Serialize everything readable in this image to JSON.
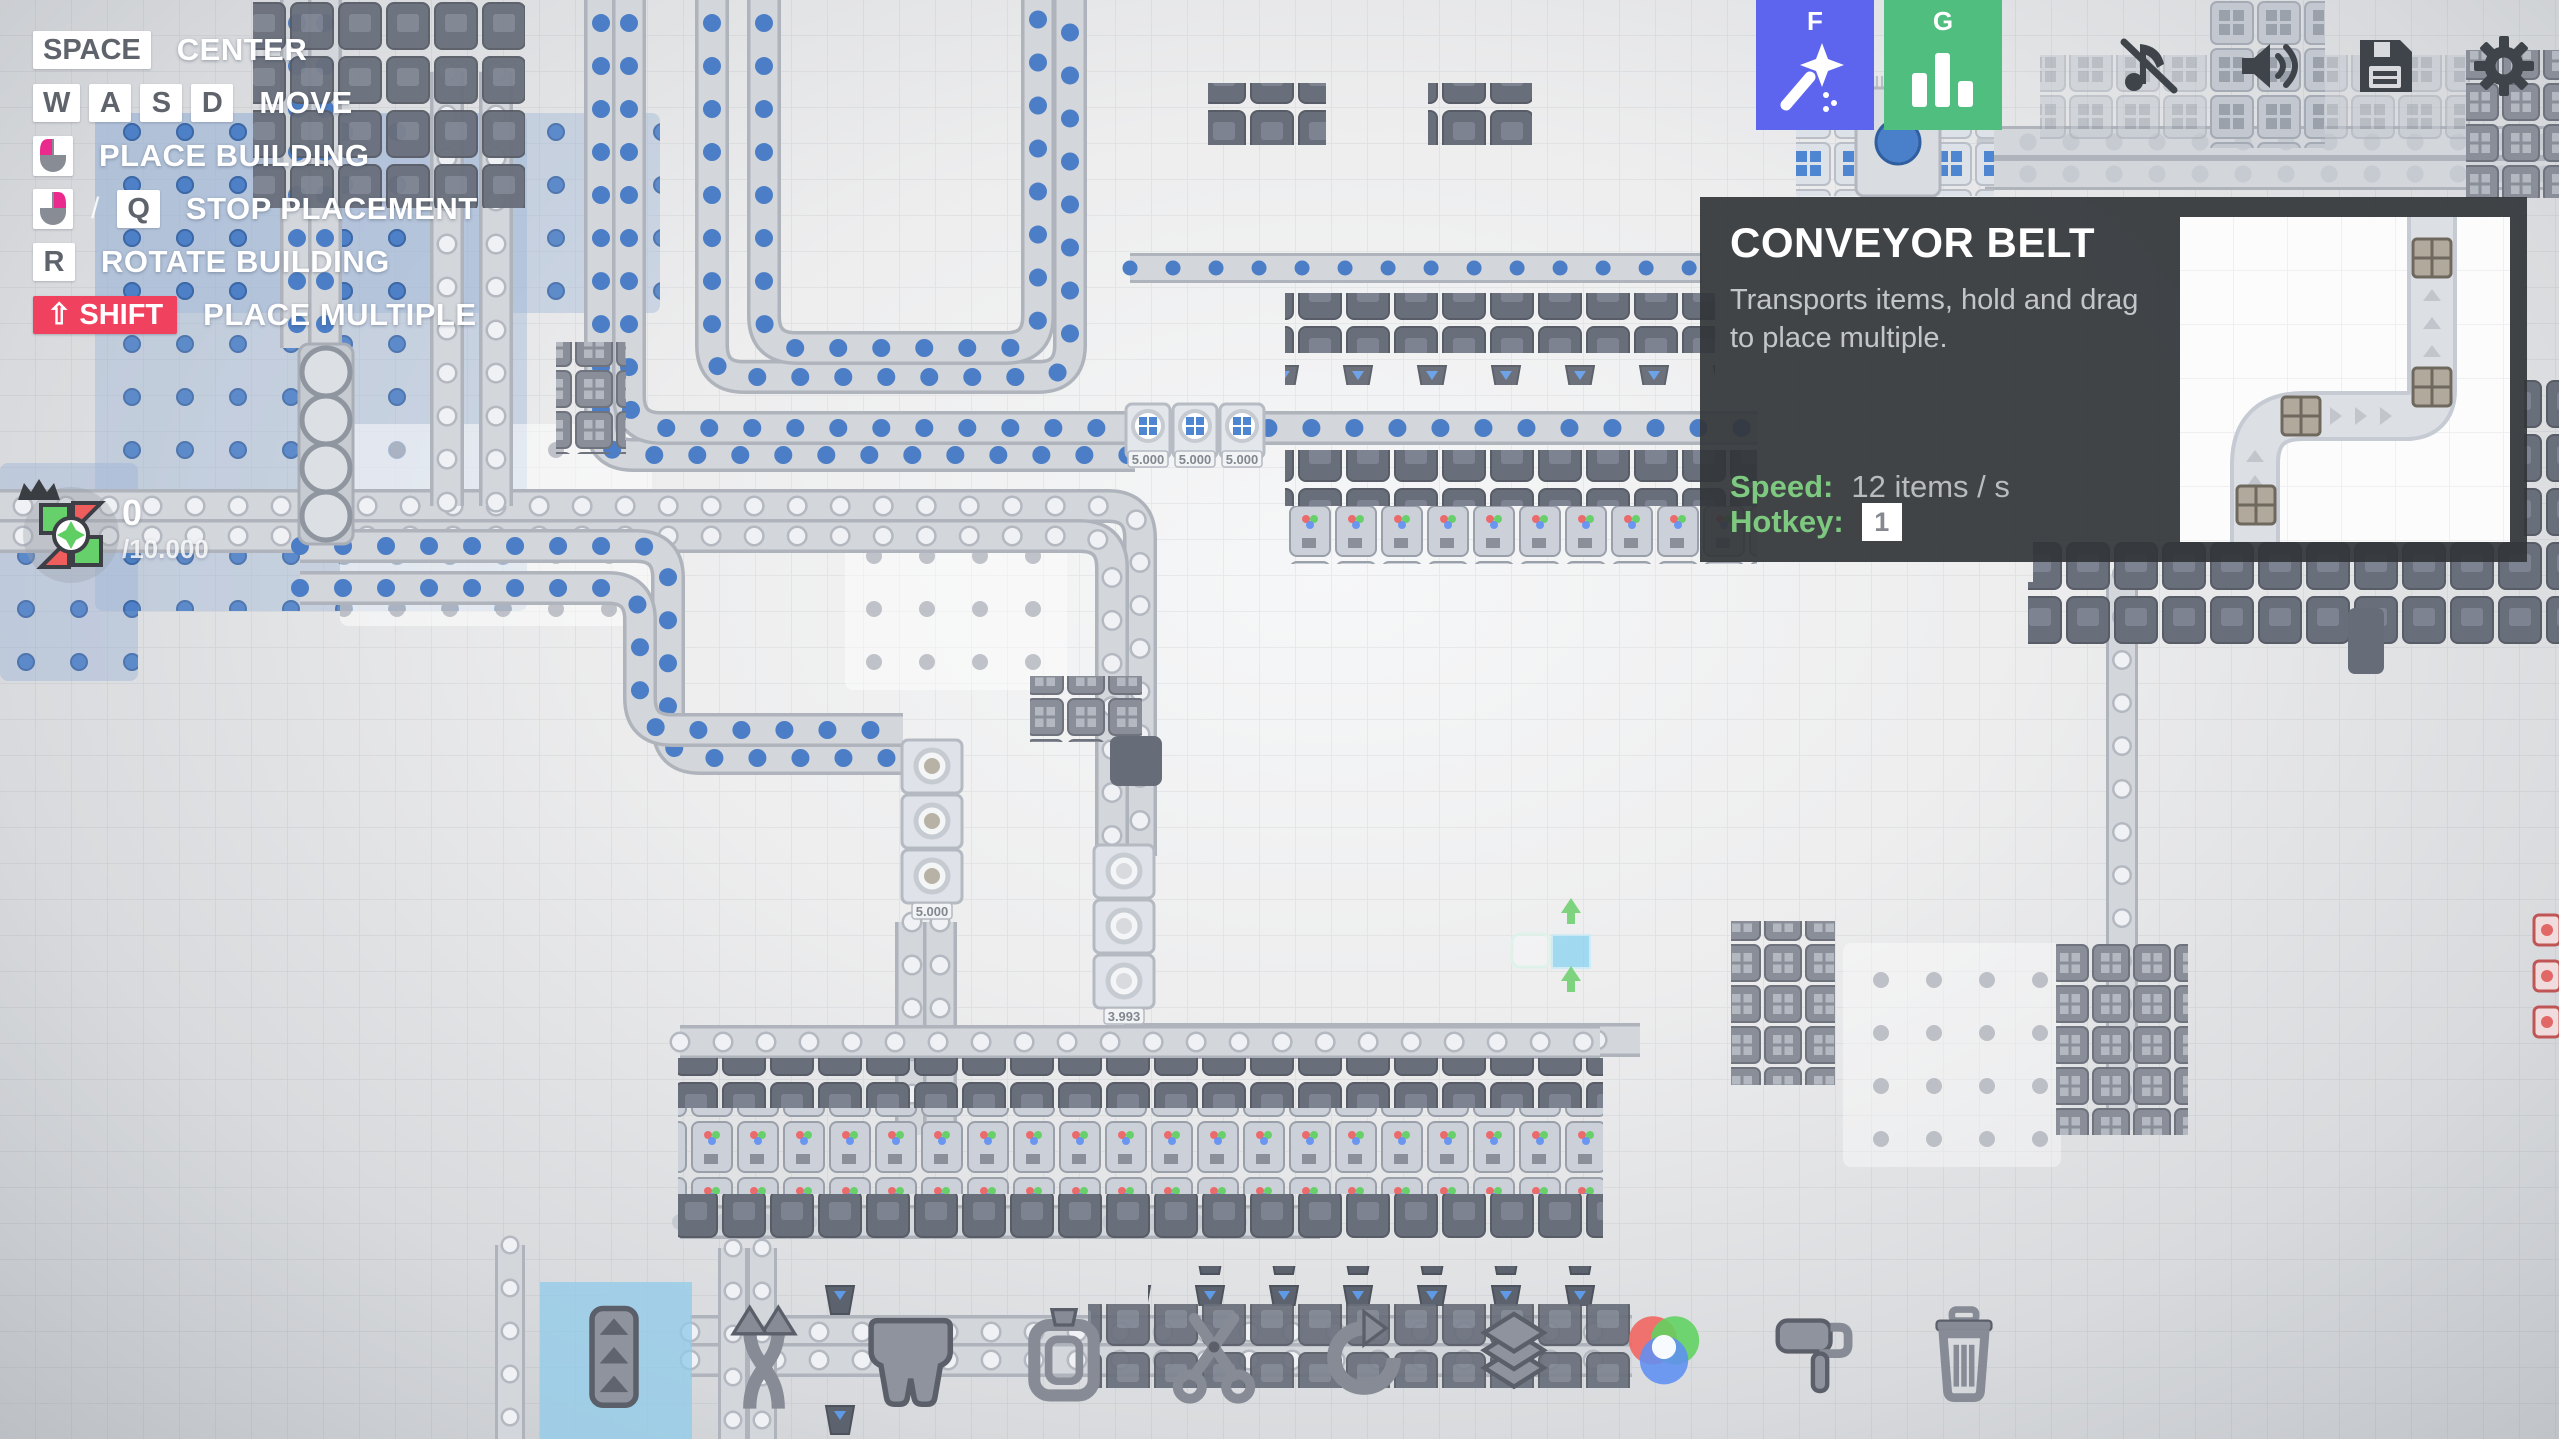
{
  "hints": {
    "rows": [
      {
        "keys": [
          "SPACE"
        ],
        "label": "CENTER"
      },
      {
        "keys": [
          "W",
          "A",
          "S",
          "D"
        ],
        "label": "MOVE"
      },
      {
        "mouse": "left-button",
        "label": "PLACE BUILDING"
      },
      {
        "mouse": "right-button",
        "separator": "/",
        "keys": [
          "Q"
        ],
        "label": "STOP PLACEMENT"
      },
      {
        "keys": [
          "R"
        ],
        "label": "ROTATE BUILDING"
      },
      {
        "keys": [
          "⇧ SHIFT"
        ],
        "label": "PLACE MULTIPLE",
        "accent": "#f0415f"
      }
    ]
  },
  "goal": {
    "current": "0",
    "total": "/10.000"
  },
  "top_right": {
    "wand_button": {
      "key": "F",
      "color": "#5d64ee",
      "icon": "magic-wand-icon"
    },
    "stats_button": {
      "key": "G",
      "color": "#4fbe7f",
      "icon": "bar-chart-icon"
    },
    "icons": [
      {
        "name": "music-muted-icon"
      },
      {
        "name": "volume-icon"
      },
      {
        "name": "save-icon"
      },
      {
        "name": "settings-gear-icon"
      }
    ]
  },
  "tooltip": {
    "title": "CONVEYOR BELT",
    "description": "Transports items, hold and drag to place multiple.",
    "speed_label": "Speed:",
    "speed_value": "12 items / s",
    "hotkey_label": "Hotkey:",
    "hotkey_value": "1",
    "accent_color": "#7dc97f"
  },
  "toolbar": {
    "selected": "belt",
    "selected_bg": "#92cce9",
    "items": [
      {
        "name": "belt",
        "icon": "belt-icon",
        "selected": true
      },
      {
        "name": "balancer",
        "icon": "balancer-icon",
        "selected": false
      },
      {
        "name": "tunnel",
        "icon": "tunnel-icon",
        "selected": false
      },
      {
        "name": "miner",
        "icon": "miner-icon",
        "selected": false
      },
      {
        "name": "cutter",
        "icon": "cutter-icon",
        "selected": false
      },
      {
        "name": "rotator",
        "icon": "rotator-icon",
        "selected": false
      },
      {
        "name": "stacker",
        "icon": "stacker-icon",
        "selected": false
      },
      {
        "name": "mixer",
        "icon": "mixer-icon",
        "selected": false
      },
      {
        "name": "painter",
        "icon": "painter-icon",
        "selected": false
      },
      {
        "name": "trash",
        "icon": "trash-icon",
        "selected": false
      }
    ]
  },
  "canvas": {
    "counters": [
      "5.000",
      "5.000",
      "5.000",
      "1.531",
      "5.000",
      "5.000",
      "5.000",
      "5.000",
      "3.993"
    ],
    "colors": {
      "item_blue": "#4b7ec6",
      "belt_track": "#d3d6db",
      "machine_dark": "#686e7a",
      "patch_blue": "#9db4d6",
      "ghost_cyan": "#79d0f2",
      "ghost_green": "#7ed37e",
      "red_item": "#e26868"
    }
  }
}
